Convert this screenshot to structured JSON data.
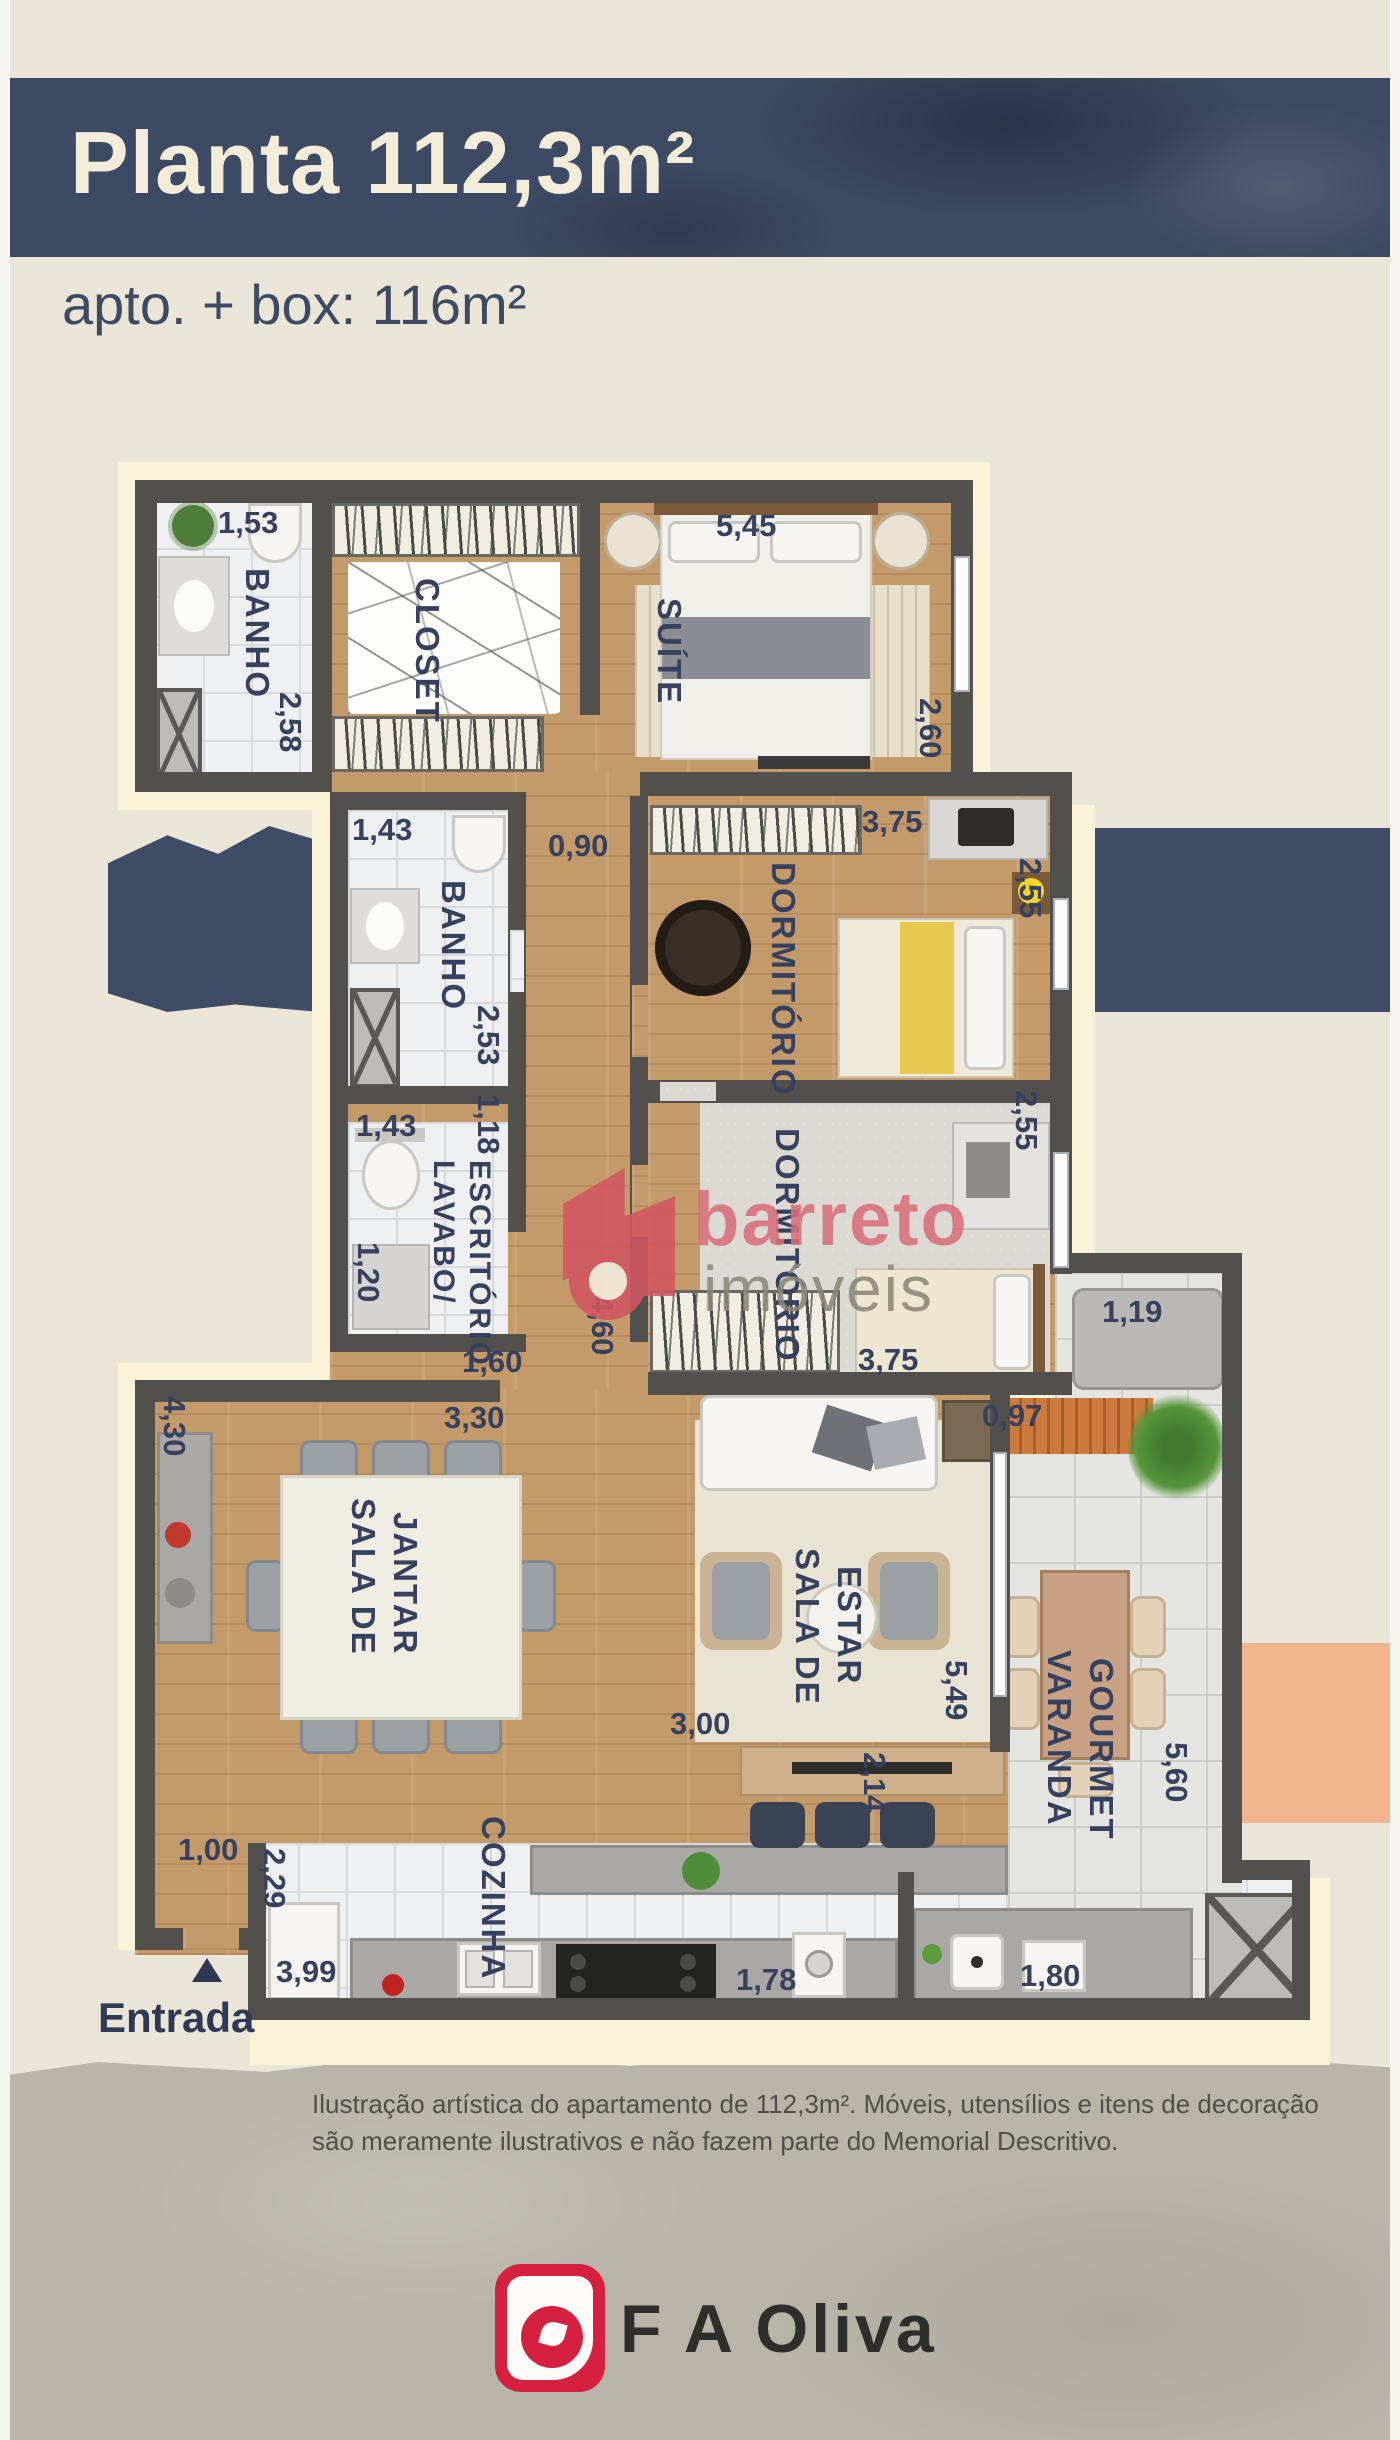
{
  "header": {
    "title": "Planta 112,3m²",
    "subtitle": "apto. + box: 116m²"
  },
  "plan": {
    "entrance_label": "Entrada",
    "rooms": {
      "banho_suite": {
        "label": "BANHO",
        "width": "1,53",
        "height": "2,58"
      },
      "closet": {
        "label": "CLOSET"
      },
      "suite": {
        "label": "SUÍTE",
        "width": "5,45",
        "height": "2,60"
      },
      "hall": {
        "width": "0,90",
        "height": "4,60",
        "opening": "1,60",
        "span": "3,30"
      },
      "banho_social": {
        "label": "BANHO",
        "width": "1,43",
        "height": "2,53"
      },
      "dormitorio1": {
        "label": "DORMITÓRIO",
        "width": "3,75",
        "height": "2,55"
      },
      "lavabo": {
        "label_line1": "LAVABO/",
        "label_line2": "ESCRITÓRIO",
        "width": "1,43",
        "height": "1,18",
        "depth": "1,20"
      },
      "dormitorio2": {
        "label": "DORMITÓRIO",
        "width": "3,75",
        "height": "2,55"
      },
      "sala_jantar": {
        "label_line1": "SALA DE",
        "label_line2": "JANTAR",
        "height": "4,30"
      },
      "sala_estar": {
        "label_line1": "SALA DE",
        "label_line2": "ESTAR",
        "width": "3,00"
      },
      "varanda": {
        "label_line1": "VARANDA",
        "label_line2": "GOURMET",
        "alcove": "1,19",
        "width": "0,97",
        "height": "5,49",
        "height2": "5,60"
      },
      "cozinha": {
        "label": "COZINHA",
        "height": "2,29",
        "wall": "1,00",
        "width": "3,99",
        "width2": "1,78",
        "passage": "2,14"
      },
      "servico": {
        "width": "1,80"
      }
    }
  },
  "watermark": {
    "word1": "barreto",
    "word2": "imóveis"
  },
  "disclaimer": {
    "line1": "Ilustração artística do apartamento de 112,3m². Móveis, utensílios e itens de decoração",
    "line2": "são meramente ilustrativos e não fazem parte do Memorial Descritivo."
  },
  "footer": {
    "brand": "F A Oliva"
  },
  "colors": {
    "banner": "#3c4a63",
    "paper": "#eae5d6",
    "mat": "#faf3d8",
    "wall": "#51504c",
    "navy_text": "#35415e",
    "salmon": "#f2b48d",
    "logo_red": "#d5213f"
  }
}
